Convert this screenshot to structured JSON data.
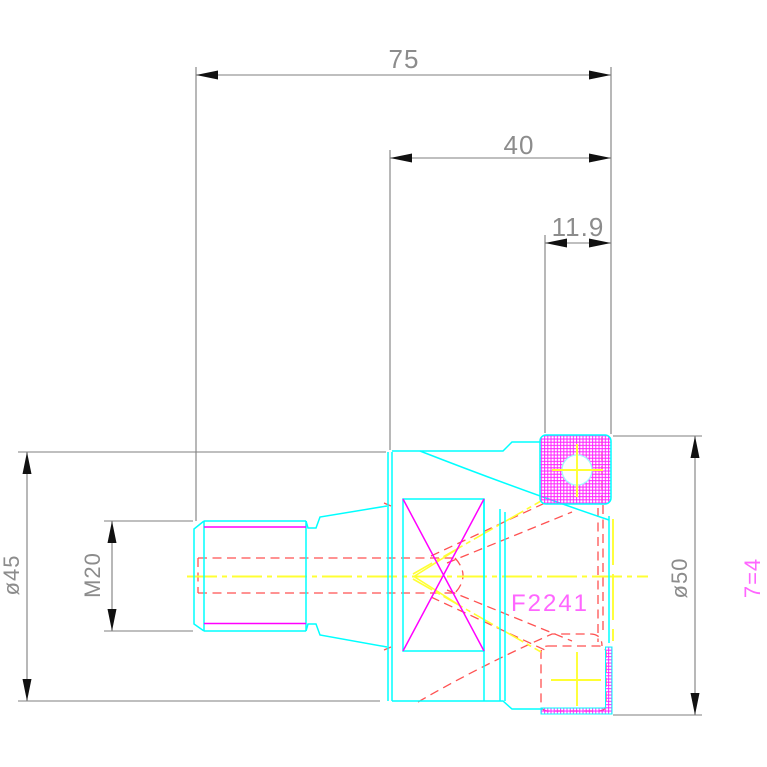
{
  "drawing": {
    "labels": {
      "part_number": "F2241",
      "flute_count": "7=4"
    },
    "dimensions": {
      "overall_length": "75",
      "head_length": "40",
      "insert_offset": "11.9",
      "body_diameter": "ø45",
      "thread_size": "M20",
      "cutting_diameter": "ø50"
    },
    "colors": {
      "visible_edges": "#00ffff",
      "hidden_edges": "#ff5252",
      "centerlines": "#ffff33",
      "thread_lines": "#ff00ff",
      "insert_hatch": "#ff22ff",
      "dimension_lines": "#7f7f7f",
      "dimension_text": "#8c8c8c",
      "label_text": "#ff66ff",
      "arrowheads": "#111111",
      "background": "#ffffff"
    }
  }
}
